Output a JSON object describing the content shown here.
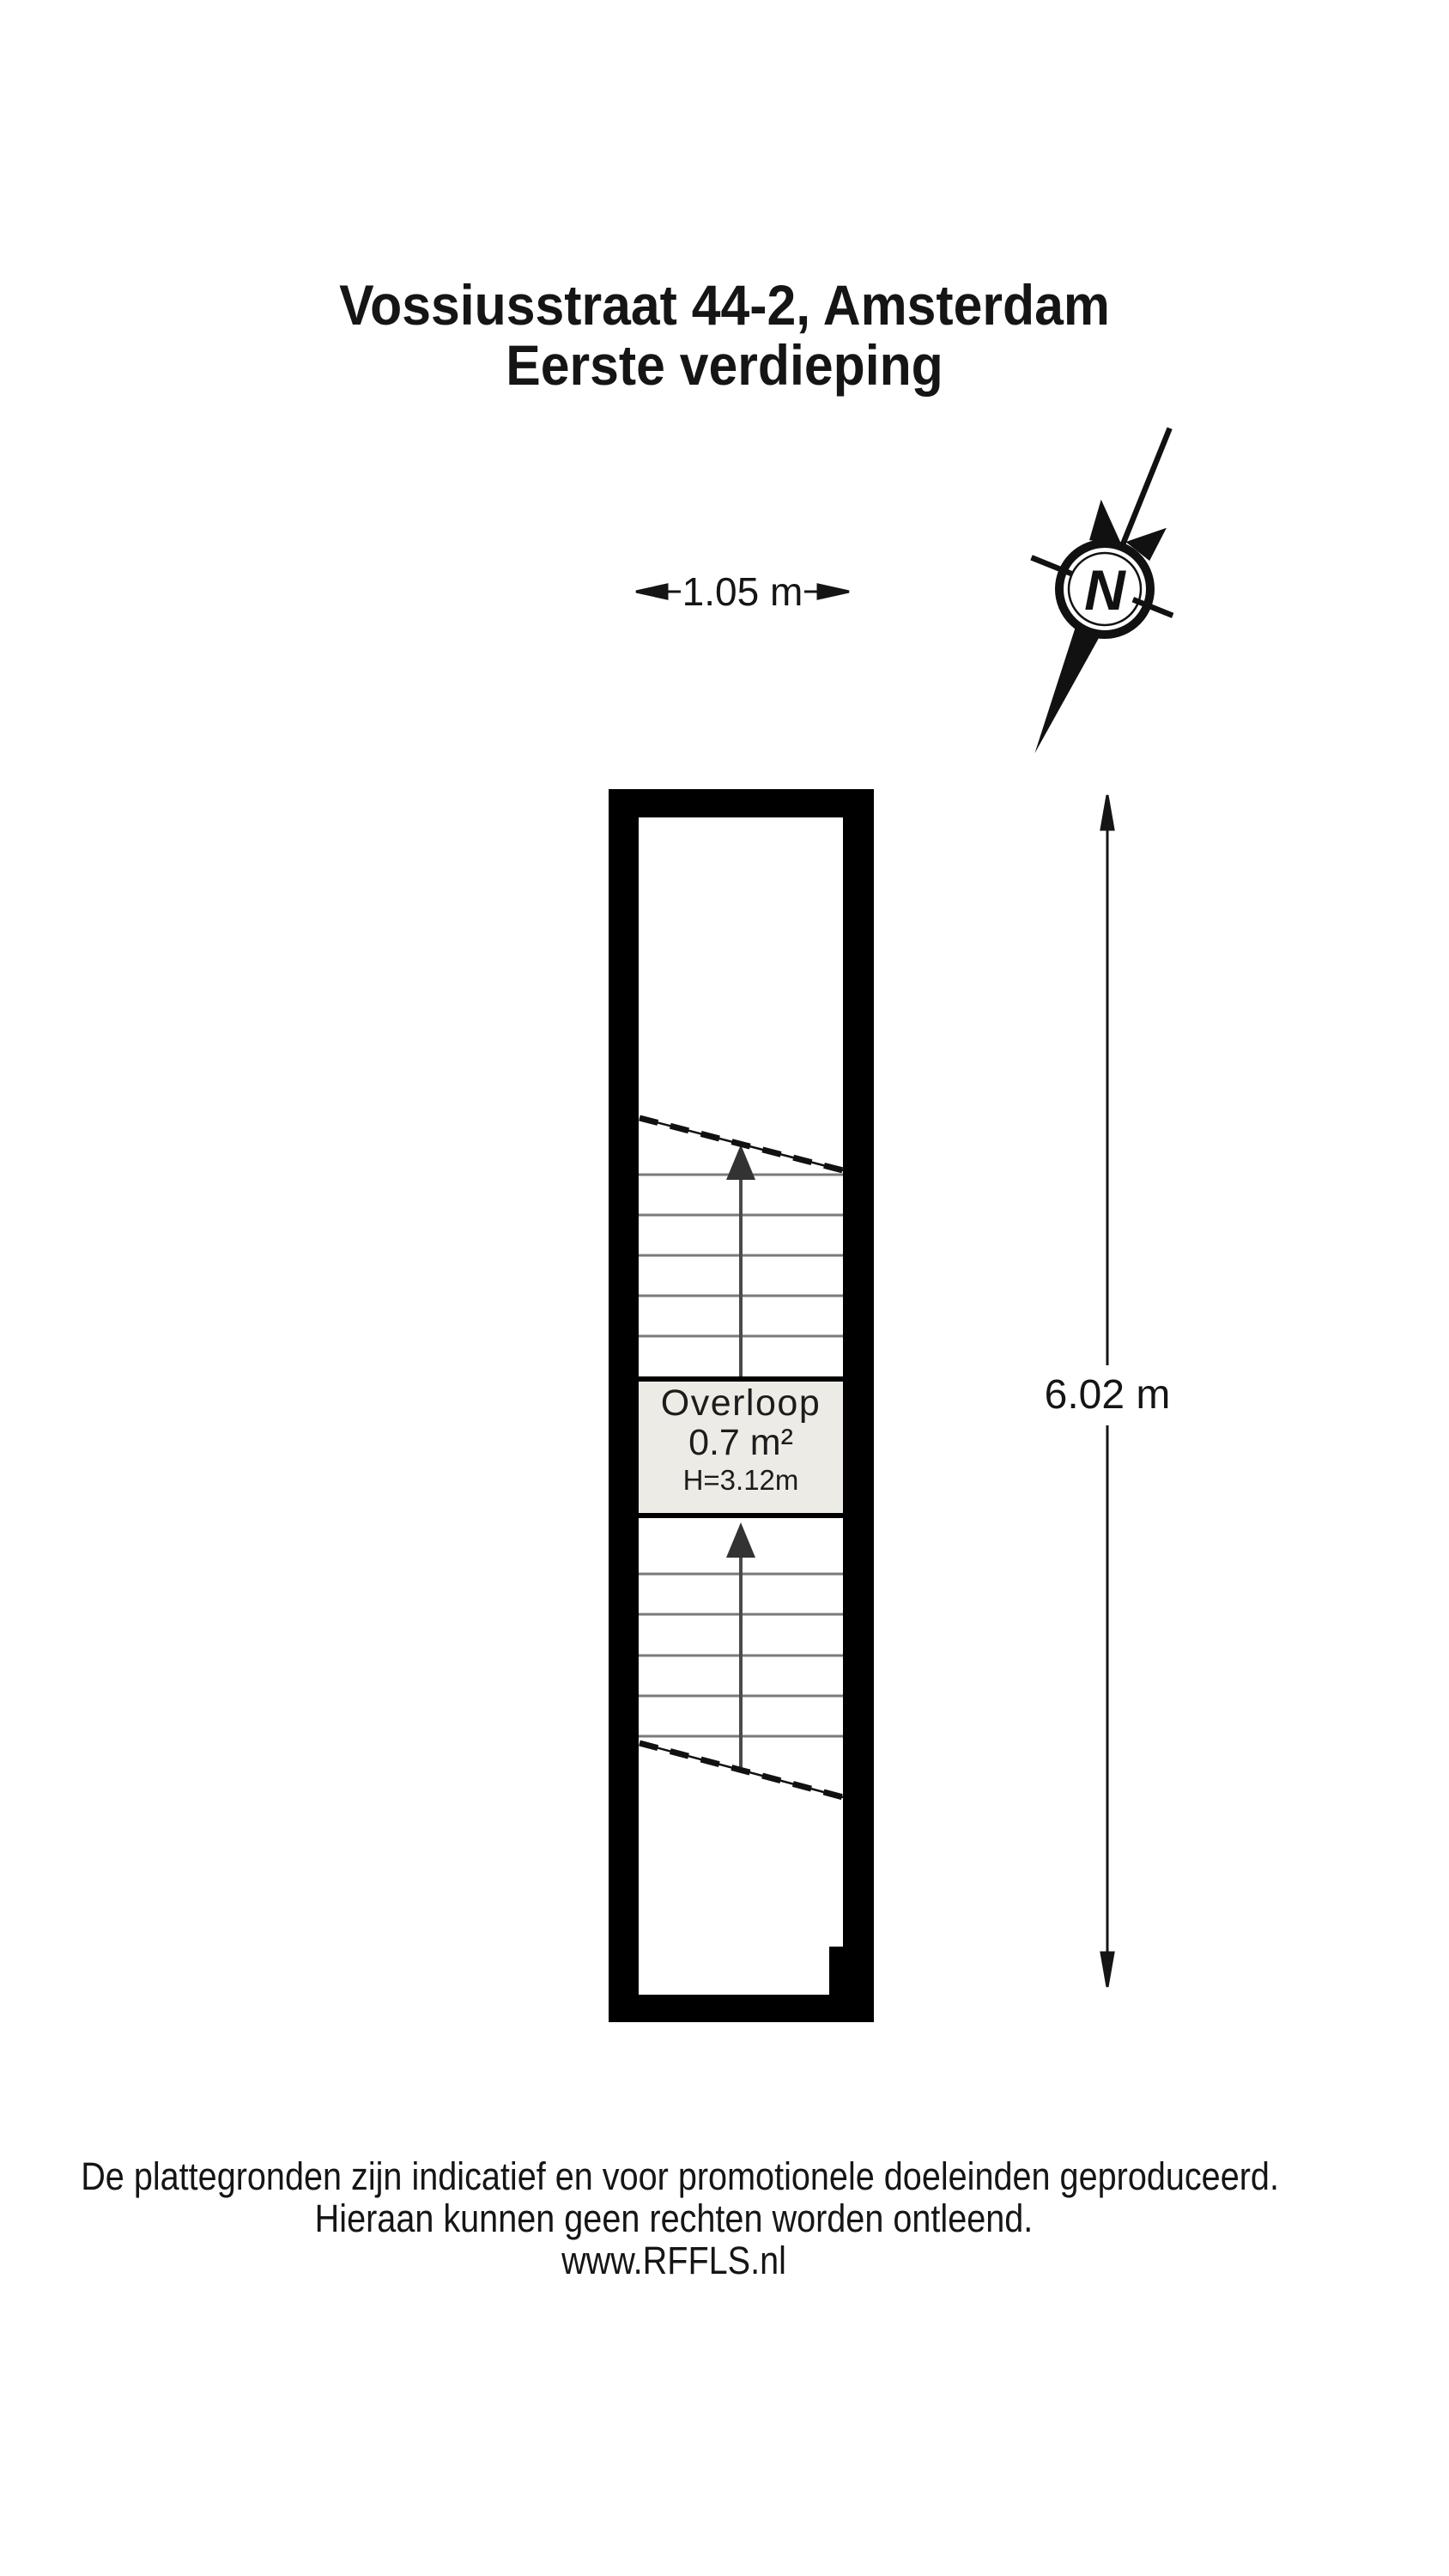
{
  "title": {
    "line1": "Vossiusstraat 44-2, Amsterdam",
    "line2": "Eerste verdieping"
  },
  "dimensions": {
    "width_label": "1.05 m",
    "height_label": "6.02 m"
  },
  "compass": {
    "label": "N",
    "icon": "north-arrow-icon"
  },
  "plan": {
    "room": {
      "name": "Overloop",
      "area": "0.7 m²",
      "ceiling": "H=3.12m"
    },
    "features": [
      "upper-staircase-up-arrow",
      "lower-staircase-up-arrow"
    ]
  },
  "footer": {
    "line1": "De plattegronden zijn indicatief en voor promotionele doeleinden geproduceerd.",
    "line2": "Hieraan kunnen geen rechten worden ontleend.",
    "line3": "www.RFFLS.nl"
  },
  "colors": {
    "wall": "#000000",
    "room_fill": "#edebe5",
    "stair_tread": "#7a7a7a",
    "stair_arrow_shaft": "#4a4a4a",
    "stair_arrow_head": "#333333",
    "text": "#151515",
    "background": "#ffffff"
  }
}
